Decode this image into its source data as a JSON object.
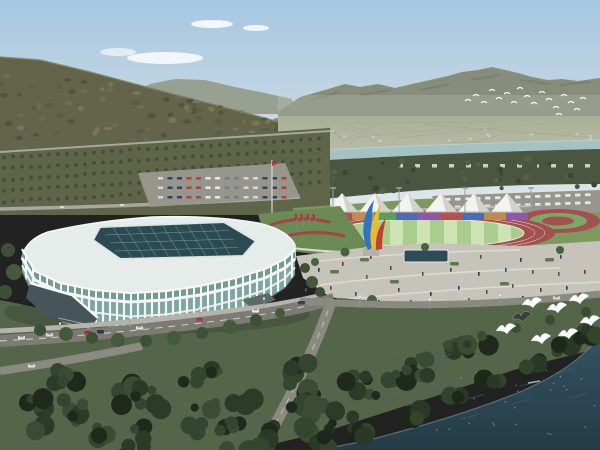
{
  "scene": {
    "title": "Aerial rendering of a riverside sports complex",
    "landmarks": {
      "stadium": "white ribbed arena with dark glass skylight roof",
      "athletics_field": "striped green infield with red running track",
      "tent_row": "row of white peaked canopies",
      "sculpture": "blue-yellow-red flame sculpture",
      "river": "pale river band below forested mountains",
      "waterfront": "dark teal water with gulls over shoreline trees"
    }
  },
  "palette": {
    "sky_top": "#a6c6e1",
    "sky_mid": "#c9dae4",
    "sky_horizon": "#e0e7e9",
    "cloud": "#ffffff",
    "far_ridge": "#98a092",
    "mountain": "#878d7a",
    "mountain_shade": "#6e7464",
    "haze": "#c9cfc9",
    "valley_top": "#a9af97",
    "valley_bottom": "#b9bba5",
    "town": "#cfcfc3",
    "river": "#a4c1c3",
    "river_light": "#c6dada",
    "tree_band": "#4b5640",
    "tree_dark": "#3b4733",
    "hill": "#64644a",
    "hill_dark": "#4e5140",
    "hill_light": "#82815c",
    "orchard": "#5f6549",
    "orchard_tree": "#474f30",
    "road_light": "#a9a79d",
    "road": "#7c7c75",
    "road_mid": "#8a8a81",
    "sidewalk": "#b5b3aa",
    "parking": "#97968d",
    "tent": "#f3f3ef",
    "tent_shade": "#d2d2cc",
    "frame": "#b9bdb5",
    "track": "#a35050",
    "field": "#a9cd8a",
    "field_pale": "#cfe2b4",
    "court_green": "#7ba868",
    "lane": "#e9e9e1",
    "lawn": "#7d9960",
    "lawn_dark": "#55654a",
    "stadium_roof": "#e6ecea",
    "skylight": "#2b4a52",
    "skylight_grid": "#7fa0a4",
    "glass": "#7fa5a2",
    "glass_dark": "#6f968f",
    "rib": "#f1f5f3",
    "eave": "#f4f7f5",
    "entrance": "#46555a",
    "plaza": "#c5c3ba",
    "path_line": "#dddbd2",
    "pool": "#2d4c58",
    "pool_rim": "#e6e6de",
    "hedge": "#5d7a4a",
    "fg_tree": "#2c3a28",
    "fg_tree2": "#354630",
    "fg_tree_dark": "#1f2a1c",
    "shore_tree": "#2a3826",
    "water_top": "#35525f",
    "water_bottom": "#233c47",
    "water_streak": "#44626f",
    "foam": "#7e949b",
    "bird": "#ffffff",
    "gull_dark": "#3a3f38",
    "sculpt_blue": "#2f74c4",
    "sculpt_yellow": "#e6bd2e",
    "sculpt_red": "#c4402e",
    "pedestal": "#b4b2a8",
    "flower": "#a04646",
    "garden": "#6c8a54",
    "flag_red": "#b03838"
  },
  "sports": {
    "tents": {
      "count": 6,
      "xs": [
        342,
        375,
        408,
        441,
        474,
        507
      ]
    },
    "stand_stripe_colors": [
      "#b25252",
      "#c28a4a",
      "#5a9e5a",
      "#4c6cb5",
      "#8c59aa",
      "#b25252",
      "#4c6cb5",
      "#c28a4a",
      "#8c59aa"
    ],
    "field_stripe_count": 7
  },
  "people": {
    "count": 36,
    "positions": [
      [
        318,
        268
      ],
      [
        330,
        286
      ],
      [
        342,
        262
      ],
      [
        355,
        292
      ],
      [
        366,
        275
      ],
      [
        378,
        300
      ],
      [
        390,
        266
      ],
      [
        398,
        288
      ],
      [
        410,
        300
      ],
      [
        422,
        272
      ],
      [
        430,
        292
      ],
      [
        442,
        304
      ],
      [
        450,
        268
      ],
      [
        458,
        286
      ],
      [
        468,
        298
      ],
      [
        478,
        272
      ],
      [
        486,
        290
      ],
      [
        495,
        303
      ],
      [
        505,
        268
      ],
      [
        512,
        284
      ],
      [
        522,
        296
      ],
      [
        532,
        270
      ],
      [
        540,
        288
      ],
      [
        550,
        299
      ],
      [
        558,
        272
      ],
      [
        566,
        286
      ],
      [
        575,
        295
      ],
      [
        584,
        270
      ],
      [
        560,
        255
      ],
      [
        480,
        255
      ],
      [
        520,
        258
      ],
      [
        420,
        256
      ],
      [
        370,
        255
      ],
      [
        340,
        299
      ],
      [
        305,
        288
      ],
      [
        312,
        295
      ]
    ]
  },
  "vehicles": {
    "boulevard": [
      {
        "x": 18,
        "y": 336,
        "color": "#e6e6e4"
      },
      {
        "x": 46,
        "y": 333,
        "color": "#dcdcda"
      },
      {
        "x": 84,
        "y": 331,
        "color": "#a83c3c"
      },
      {
        "x": 97,
        "y": 330,
        "color": "#2f3a46"
      },
      {
        "x": 136,
        "y": 326,
        "color": "#e2e2e0"
      },
      {
        "x": 196,
        "y": 318,
        "color": "#b04444"
      },
      {
        "x": 252,
        "y": 309,
        "color": "#e8e8e6"
      },
      {
        "x": 298,
        "y": 301,
        "color": "#3a4452"
      }
    ],
    "branch": [
      {
        "x": 28,
        "y": 364,
        "color": "#e0e0e0"
      }
    ],
    "promenade": [
      {
        "x": 553,
        "y": 296,
        "color": "#d8d8d8"
      },
      {
        "x": 578,
        "y": 293,
        "color": "#8a4040"
      }
    ]
  },
  "birds": {
    "flock": {
      "count": 18,
      "positions": [
        [
          468,
          101
        ],
        [
          476,
          96
        ],
        [
          484,
          103
        ],
        [
          492,
          91
        ],
        [
          499,
          99
        ],
        [
          507,
          94
        ],
        [
          514,
          103
        ],
        [
          520,
          89
        ],
        [
          527,
          97
        ],
        [
          534,
          104
        ],
        [
          542,
          93
        ],
        [
          549,
          100
        ],
        [
          556,
          108
        ],
        [
          564,
          96
        ],
        [
          571,
          103
        ],
        [
          577,
          110
        ],
        [
          583,
          99
        ],
        [
          559,
          115
        ]
      ]
    },
    "gulls": {
      "count": 7,
      "positions": [
        [
          532,
          303
        ],
        [
          557,
          308
        ],
        [
          579,
          299
        ],
        [
          506,
          329
        ],
        [
          541,
          339
        ],
        [
          568,
          334
        ],
        [
          590,
          321
        ]
      ],
      "dark_gull": [
        522,
        317
      ]
    }
  }
}
